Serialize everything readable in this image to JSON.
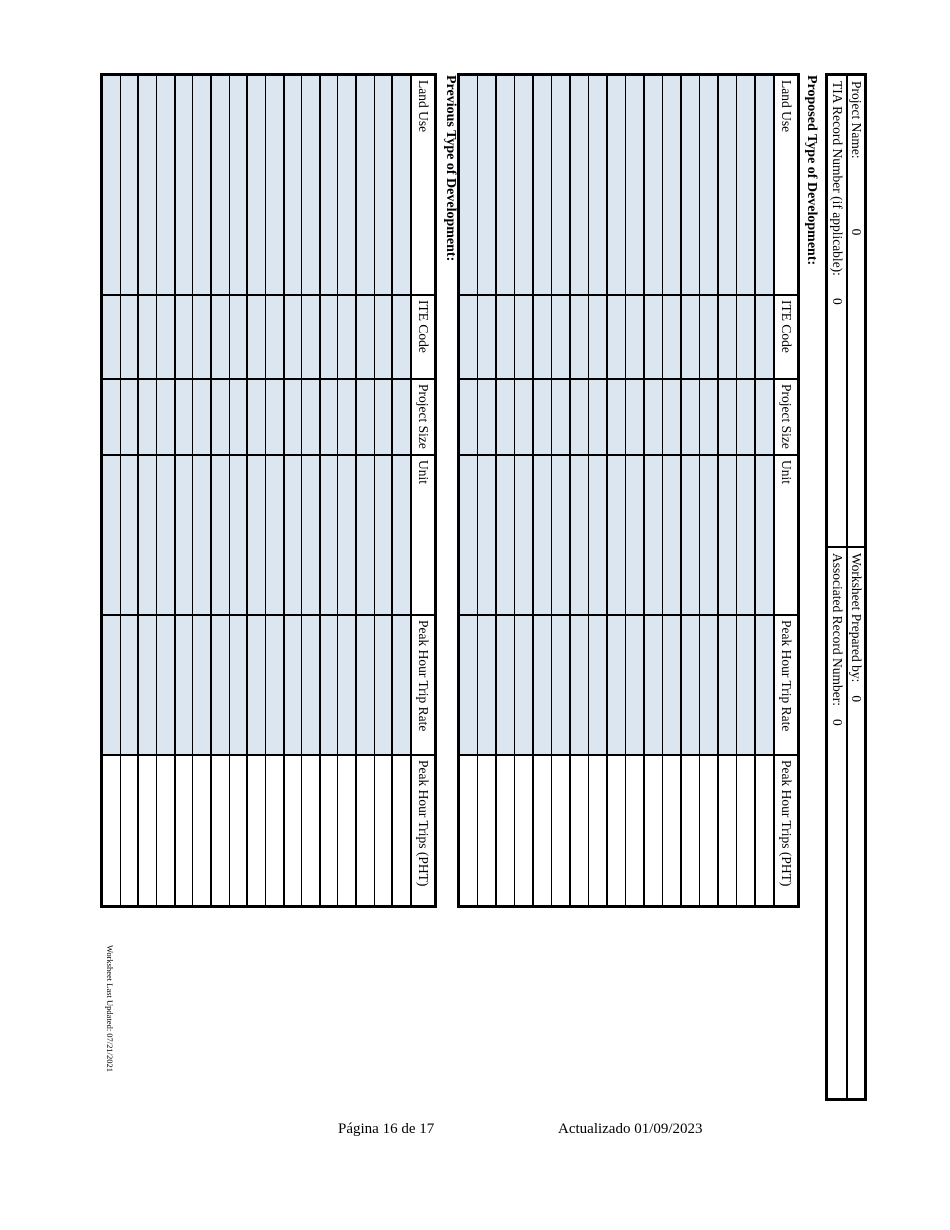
{
  "colors": {
    "row_fill": "#dce6f1",
    "border": "#000000",
    "background": "#ffffff"
  },
  "header_info": {
    "rows": [
      {
        "left_label": "Project Name:",
        "left_value": "0",
        "right_label": "Worksheet Prepared by:",
        "right_value": "0"
      },
      {
        "left_label": "TIA Record Number (if applicable):",
        "left_value": "0",
        "right_label": "Associated Record Number:",
        "right_value": "0"
      }
    ]
  },
  "sections": [
    {
      "heading": "Proposed Type of Development:",
      "columns": [
        "Land Use",
        "ITE Code",
        "Project Size",
        "Unit",
        "Peak Hour Trip Rate",
        "Peak Hour Trips (PHT)"
      ],
      "data_row_count": 17,
      "cell_value": ""
    },
    {
      "heading": "Previous Type of Development:",
      "columns": [
        "Land Use",
        "ITE Code",
        "Project Size",
        "Unit",
        "Peak Hour Trip Rate",
        "Peak Hour Trips (PHT)"
      ],
      "data_row_count": 17,
      "cell_value": ""
    }
  ],
  "worksheet_note": "Worksheet Last Updated: 07/21/2021",
  "page_footer": {
    "left": "Página 16 de 17",
    "right": "Actualizado 01/09/2023"
  }
}
